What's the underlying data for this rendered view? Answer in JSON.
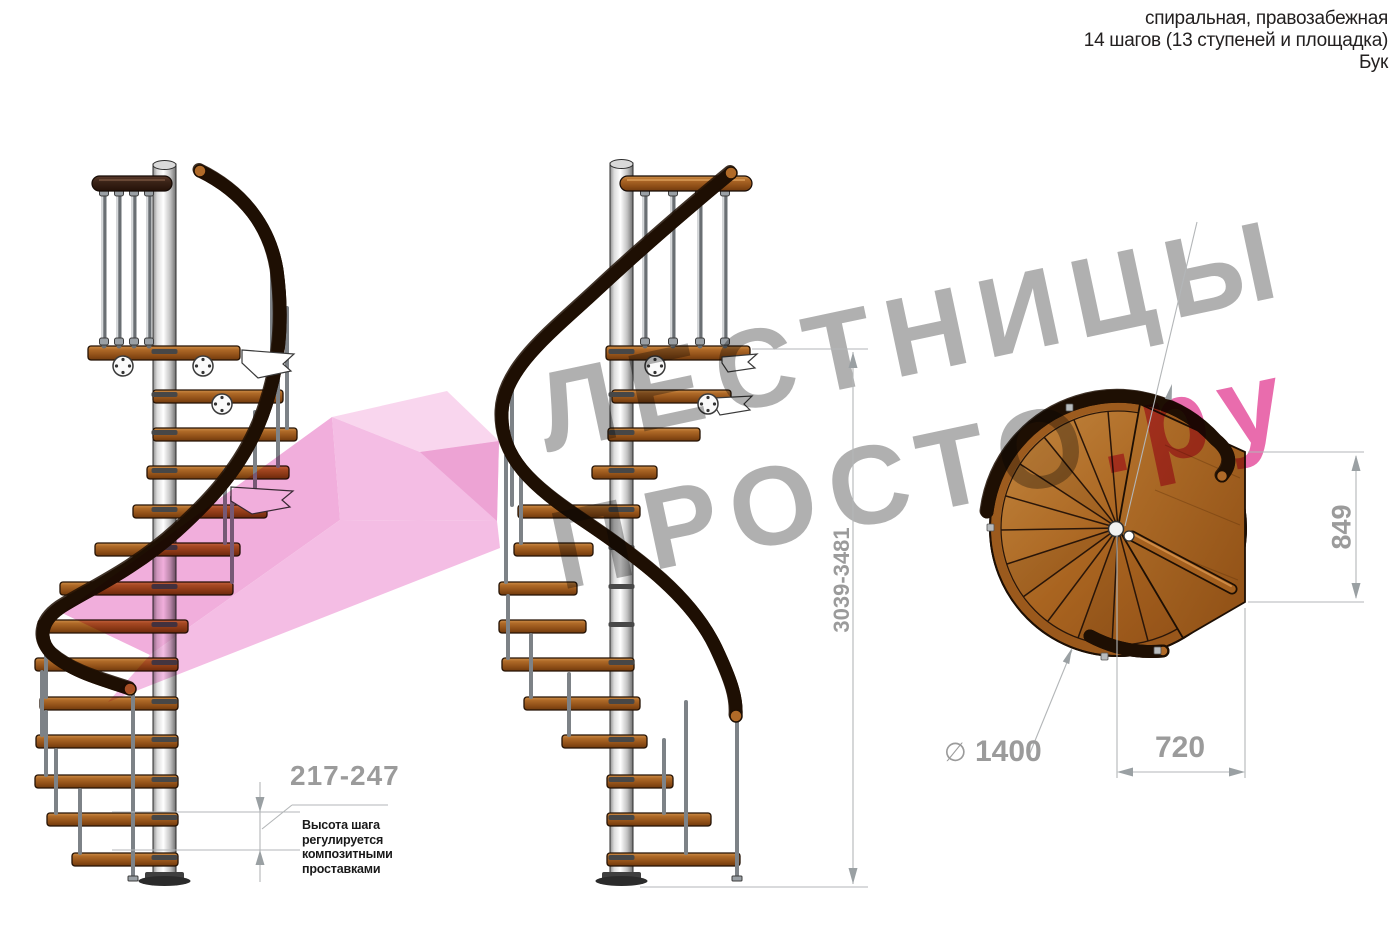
{
  "header": {
    "line1": "спиральная, правозабежная",
    "line2": "14 шагов (13 ступеней и площадка)",
    "line3": "Бук"
  },
  "watermark": {
    "line1": "ЛЕСТНИЦЫ",
    "line2_gray": "ПРОСТО",
    "line2_pink": ".ру",
    "gray_color": "#a9a9a9",
    "pink_color": "#e75fa6"
  },
  "dimensions": {
    "total_height": "3039-3481",
    "step_height": "217-247",
    "step_height_note": "Высота шага\nрегулируется\nкомпозитными\nпроставками",
    "landing_side": "849",
    "exit_width": "720",
    "diameter_symbol": "∅",
    "diameter_value": "1400"
  },
  "colors": {
    "wood_light": "#cf9049",
    "wood_mid": "#a96420",
    "wood_dark": "#6f3a0e",
    "walnut_rail": "#3a2317",
    "pole_gray": "#c4c4c4",
    "dimension_gray": "#9b9b9b",
    "watermark_pink": "#e75fa6"
  }
}
